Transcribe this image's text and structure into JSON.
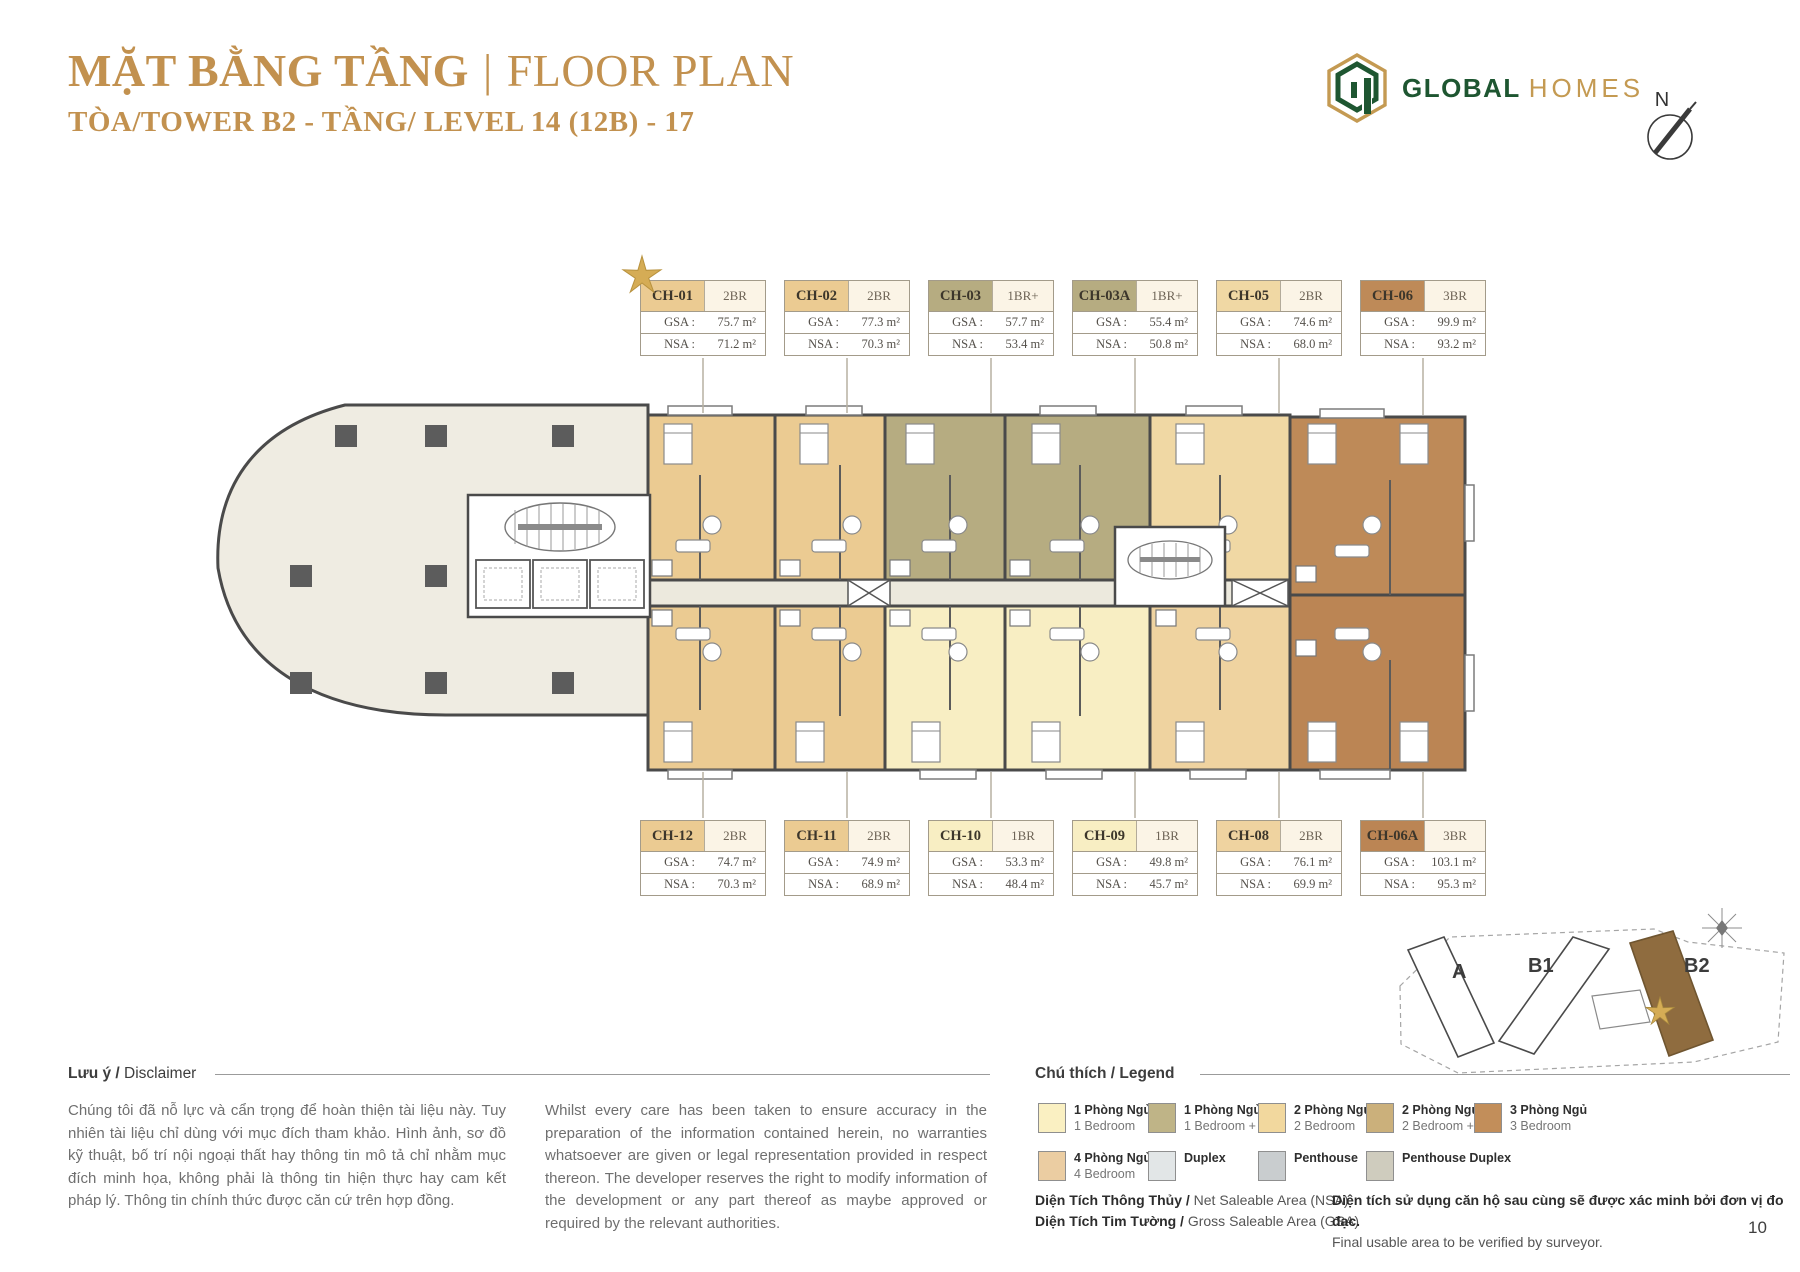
{
  "header": {
    "title_vn": "MẶT BẰNG TẦNG",
    "divider": "|",
    "title_en": "FLOOR PLAN",
    "subtitle": "TÒA/TOWER B2 - TẦNG/ LEVEL 14 (12B) - 17",
    "brand": {
      "primary": "GLOBAL",
      "secondary": "HOMES"
    },
    "compass_label": "N"
  },
  "labels": {
    "gsa": "GSA :",
    "nsa": "NSA :"
  },
  "units_top": [
    {
      "id": "CH-01",
      "type": "2BR",
      "gsa": "75.7 m²",
      "nsa": "71.2 m²",
      "color": "#EBCB92",
      "starred": true
    },
    {
      "id": "CH-02",
      "type": "2BR",
      "gsa": "77.3 m²",
      "nsa": "70.3 m²",
      "color": "#EBCB92"
    },
    {
      "id": "CH-03",
      "type": "1BR+",
      "gsa": "57.7 m²",
      "nsa": "53.4 m²",
      "color": "#B6AC81"
    },
    {
      "id": "CH-03A",
      "type": "1BR+",
      "gsa": "55.4 m²",
      "nsa": "50.8 m²",
      "color": "#B6AC81"
    },
    {
      "id": "CH-05",
      "type": "2BR",
      "gsa": "74.6 m²",
      "nsa": "68.0 m²",
      "color": "#F0D8A4"
    },
    {
      "id": "CH-06",
      "type": "3BR",
      "gsa": "99.9 m²",
      "nsa": "93.2 m²",
      "color": "#BE8A58"
    }
  ],
  "units_bottom": [
    {
      "id": "CH-12",
      "type": "2BR",
      "gsa": "74.7 m²",
      "nsa": "70.3 m²",
      "color": "#EBCB92"
    },
    {
      "id": "CH-11",
      "type": "2BR",
      "gsa": "74.9 m²",
      "nsa": "68.9 m²",
      "color": "#EBCB92"
    },
    {
      "id": "CH-10",
      "type": "1BR",
      "gsa": "53.3 m²",
      "nsa": "48.4 m²",
      "color": "#F8EEC3"
    },
    {
      "id": "CH-09",
      "type": "1BR",
      "gsa": "49.8 m²",
      "nsa": "45.7 m²",
      "color": "#F8EEC3"
    },
    {
      "id": "CH-08",
      "type": "2BR",
      "gsa": "76.1 m²",
      "nsa": "69.9 m²",
      "color": "#EFD3A0"
    },
    {
      "id": "CH-06A",
      "type": "3BR",
      "gsa": "103.1 m²",
      "nsa": "95.3 m²",
      "color": "#BB8554"
    }
  ],
  "plan": {
    "podium_color": "#EFECE2",
    "corridor_color": "#ECE9DD"
  },
  "keyplan": {
    "towers": [
      {
        "label": "A"
      },
      {
        "label": "B1"
      },
      {
        "label": "B2",
        "highlighted": true
      }
    ]
  },
  "disclaimer": {
    "heading_bold": "Lưu ý /",
    "heading_normal": " Disclaimer",
    "vn": "Chúng tôi đã nỗ lực và cẩn trọng để hoàn thiện tài liệu này. Tuy nhiên tài liệu chỉ dùng với mục đích tham khảo. Hình ảnh, sơ đồ kỹ thuật, bố trí nội ngoại thất hay thông tin mô tả chỉ nhằm mục đích minh họa, không phải là thông tin hiện thực hay cam kết pháp lý. Thông tin chính thức được căn cứ trên hợp đồng.",
    "en": "Whilst every care has been taken to ensure accuracy in the preparation of the information contained herein, no warranties whatsoever are given or legal representation provided in respect thereon. The developer reserves the right to modify information of the development or any part thereof as maybe approved or required by the relevant authorities."
  },
  "legend": {
    "heading_bold": "Chú thích /",
    "heading_normal": " Legend",
    "items": [
      {
        "vn": "1 Phòng Ngủ",
        "en": "1 Bedroom",
        "color": "#FAF0C2"
      },
      {
        "vn": "1 Phòng Ngủ +",
        "en": "1 Bedroom +",
        "color": "#BFB487"
      },
      {
        "vn": "2 Phòng Ngủ",
        "en": "2 Bedroom",
        "color": "#F2D89E"
      },
      {
        "vn": "2 Phòng Ngủ +",
        "en": "2 Bedroom +",
        "color": "#CBB07B"
      },
      {
        "vn": "3 Phòng Ngủ",
        "en": "3 Bedroom",
        "color": "#C28E5A"
      },
      {
        "vn": "4 Phòng Ngủ",
        "en": "4 Bedroom",
        "color": "#EBCDA2"
      },
      {
        "vn": "Duplex",
        "en": "",
        "color": "#E2E6E7"
      },
      {
        "vn": "Penthouse",
        "en": "",
        "color": "#C9CDCF"
      },
      {
        "vn": "Penthouse Duplex",
        "en": "",
        "color": "#CFCCBE"
      }
    ]
  },
  "notes": {
    "left": [
      {
        "bold": "Diện Tích Thông Thủy /",
        "normal": " Net Saleable Area (NSA)"
      },
      {
        "bold": "Diện Tích Tim Tường /",
        "normal": " Gross Saleable Area (GSA)"
      }
    ],
    "right_bold": "Diện tích sử dụng căn hộ sau cùng sẽ được xác minh bởi đơn vị đo đạc.",
    "right_normal": "Final usable area to be verified by surveyor."
  },
  "page_number": "10",
  "colors": {
    "star": "#D5AC55",
    "star_stroke": "#B8923E",
    "brand_green": "#1E5631",
    "brand_gold": "#C49A52",
    "title_gold": "#C2914F",
    "tower_highlight": "#8F6C3F"
  }
}
